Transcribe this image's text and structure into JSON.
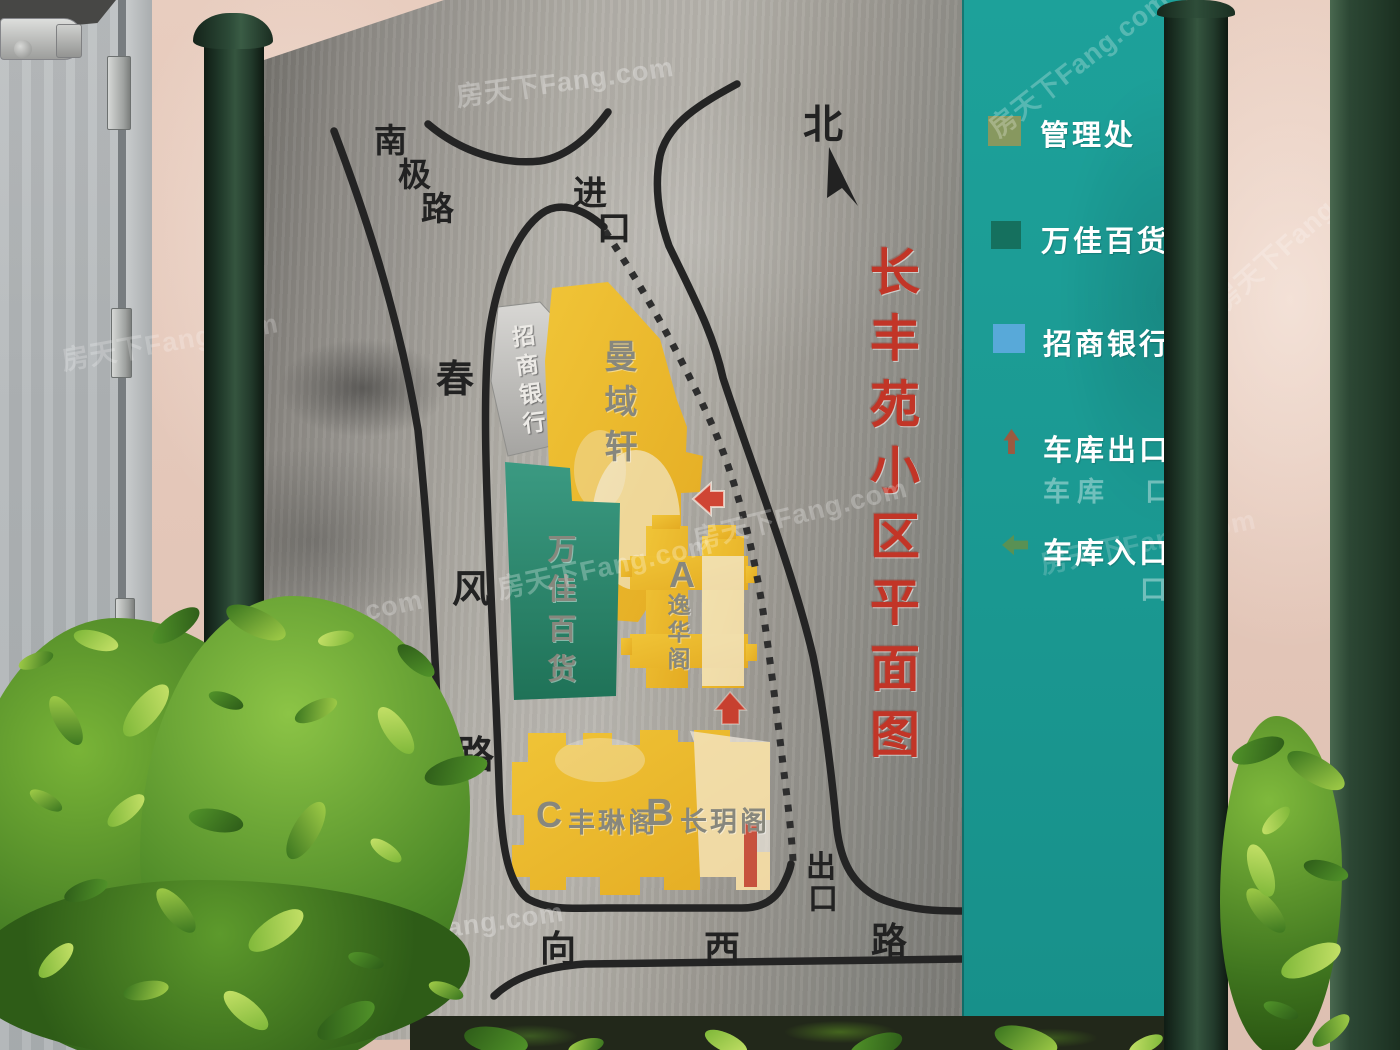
{
  "scene": {
    "watermark_text": "房天下Fang.com"
  },
  "sign": {
    "title_vertical": "长丰苑小区平面图",
    "north_label": "北",
    "roads": {
      "nanji_lu": [
        "南",
        "极",
        "路"
      ],
      "entrance": [
        "进",
        "口"
      ],
      "chunfeng_lu": [
        "春",
        "风",
        "路"
      ],
      "xiangxi_lu": [
        "向",
        "西",
        "路"
      ],
      "exit": [
        "出",
        "口"
      ]
    },
    "buildings": {
      "bank_vertical": "招商银行",
      "manyuxuan_vertical": "曼域轩",
      "wanjia_vertical": "万佳百货",
      "block_a": {
        "letter": "A",
        "name_vertical": "逸华阁"
      },
      "block_c": {
        "letter": "C",
        "name": "丰琳阁"
      },
      "block_b": {
        "letter": "B",
        "name": "长玥阁"
      }
    }
  },
  "legend": {
    "panel_color": "#1b9a93",
    "items": [
      {
        "label": "管理处",
        "swatch": "#87985f",
        "icon": "square"
      },
      {
        "label": "万佳百货",
        "swatch": "#15705e",
        "icon": "square"
      },
      {
        "label": "招商银行",
        "swatch": "#58a9d9",
        "icon": "square"
      },
      {
        "label": "车库出口",
        "swatch": "#bb4a2c",
        "icon": "arrow-up"
      },
      {
        "label": "车库入口",
        "swatch": "#6f8f3f",
        "icon": "arrow-left"
      }
    ],
    "ghost_row_1": "车库　口",
    "ghost_row_2": "口"
  },
  "colors": {
    "building_yellow": "#ecba2c",
    "building_teal": "#2d8a72",
    "building_gray": "#c6c6c3",
    "title_red": "#c23527",
    "road_black": "#242424"
  }
}
